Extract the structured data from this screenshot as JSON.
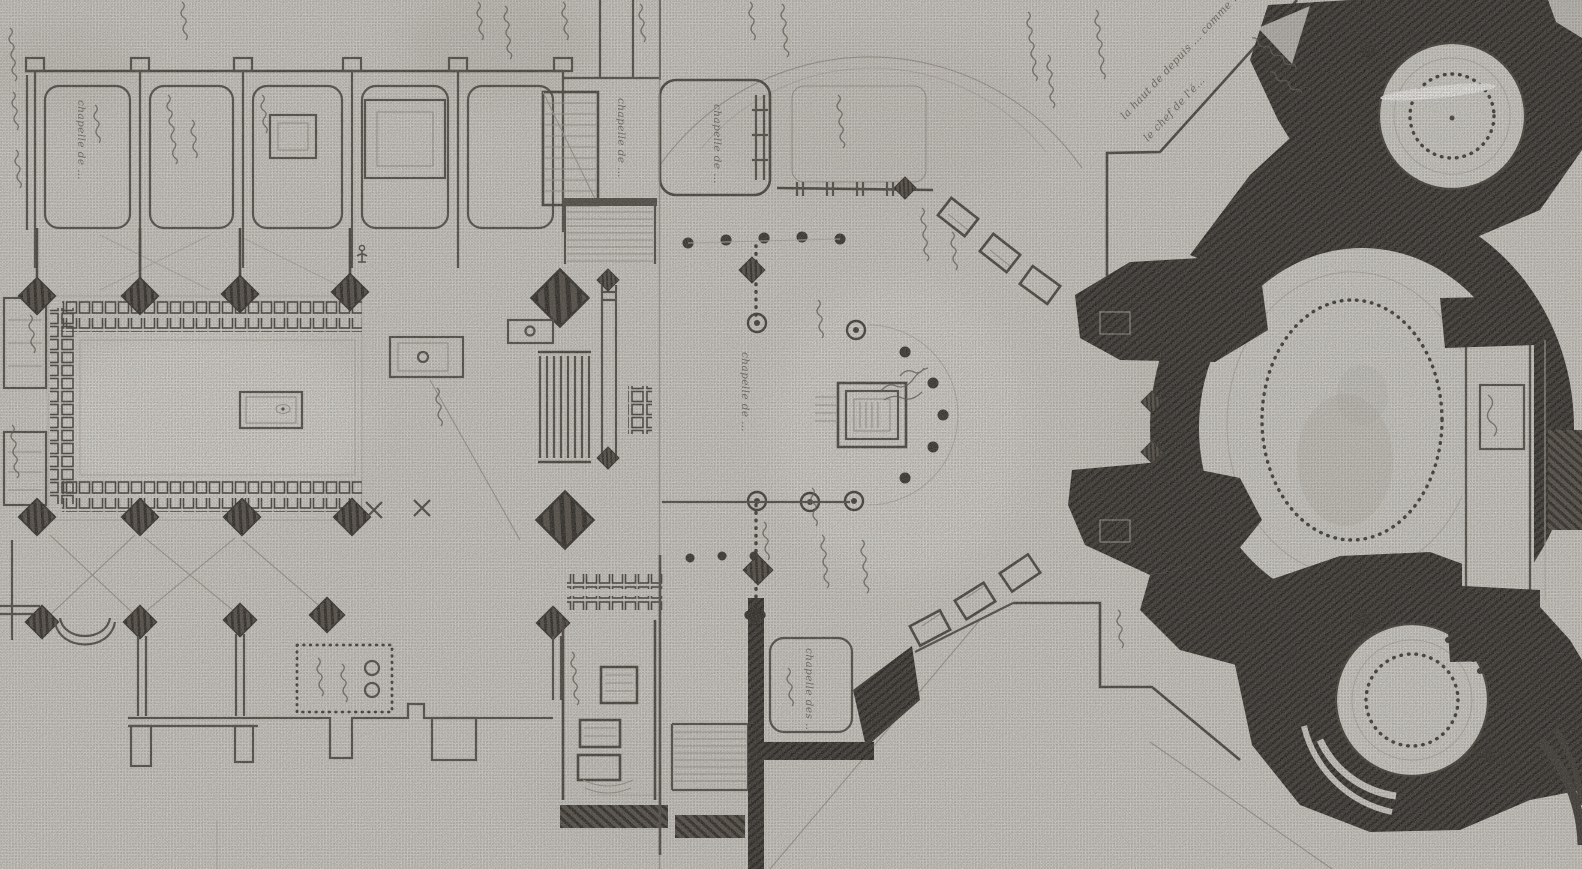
{
  "description": "Black-and-white halftone scan of a hand-drawn church floor plan: nave with side chapels and choir stalls at left, crossing and high altar with semicircular colonnade at centre, and a large domed rotunda complex with three heavily-hatched round chapels at right; vertical fold crease and handwritten French annotations, mostly illegible.",
  "palette": {
    "paper": "#d0cdc7",
    "paper_light": "#dedcd7",
    "ink": "#4a463f",
    "ink_dark": "#2e2b26",
    "ink_black": "#1d1b18",
    "faint_line": "#9b968e",
    "highlight_scratch": "#f2f1ee"
  },
  "annotations": [
    {
      "id": "north-chapel-label",
      "text": "chapelle de …"
    },
    {
      "id": "transept-chapel-label",
      "text": "chapelle de …"
    },
    {
      "id": "chancel-chapel-label",
      "text": "chapelle de …"
    },
    {
      "id": "apse-axial-chapel-label",
      "text": "chapelle de …"
    },
    {
      "id": "terrace-note-line1",
      "text": "la haut de depuis … comme …"
    },
    {
      "id": "terrace-note-line2",
      "text": "le chef de l'é…"
    },
    {
      "id": "south-chapel-label",
      "text": "chapelle des …"
    }
  ]
}
